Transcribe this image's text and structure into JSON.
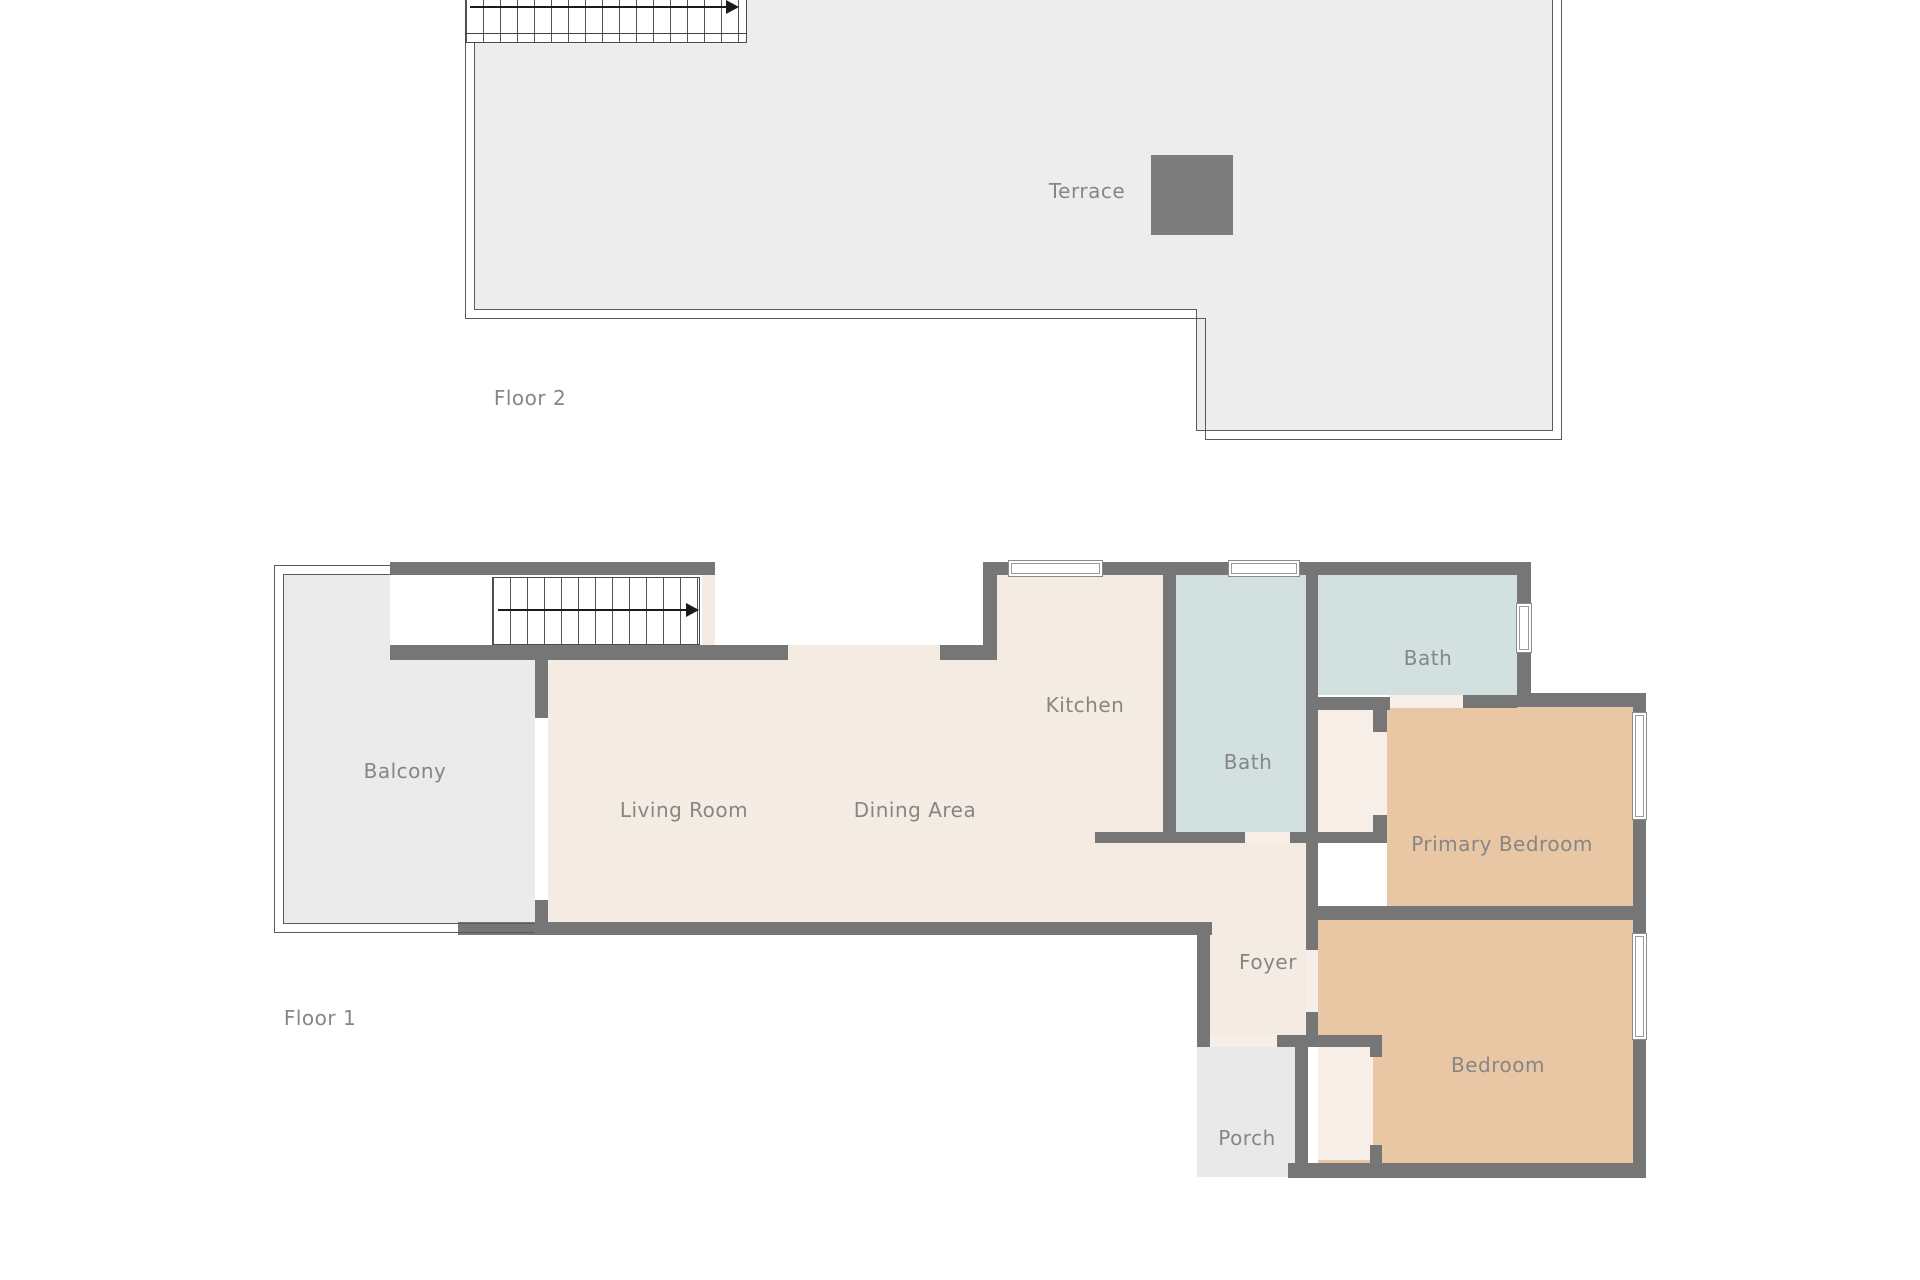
{
  "floor2": {
    "label": "Floor 2",
    "rooms": {
      "terrace": {
        "label": "Terrace"
      }
    }
  },
  "floor1": {
    "label": "Floor 1",
    "rooms": {
      "balcony": {
        "label": "Balcony"
      },
      "living": {
        "label": "Living Room"
      },
      "dining": {
        "label": "Dining Area"
      },
      "kitchen": {
        "label": "Kitchen"
      },
      "bath_upper": {
        "label": "Bath"
      },
      "bath_ensuite": {
        "label": "Bath"
      },
      "primary_bedroom": {
        "label": "Primary Bedroom"
      },
      "foyer": {
        "label": "Foyer"
      },
      "bedroom": {
        "label": "Bedroom"
      },
      "porch": {
        "label": "Porch"
      }
    }
  },
  "colors": {
    "wall": "#767676",
    "interior_floor": "#f4ebe3",
    "bathroom_floor": "#d2e0e0",
    "bedroom_floor": "#e9c7a4",
    "outdoor_floor": "#ebebeb",
    "terrace_floor": "#ededed",
    "roof_hatch": "#7d7d7d",
    "label_text": "#868686"
  }
}
